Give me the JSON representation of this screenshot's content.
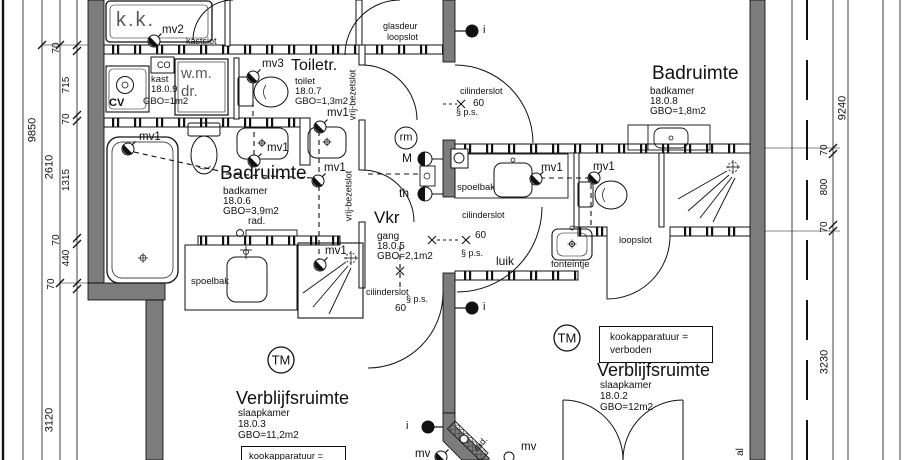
{
  "plan": {
    "rooms": {
      "kk": {
        "title": "k.k."
      },
      "kast": {
        "name": "kast",
        "number": "18.0.9",
        "area": "GBO=1m2",
        "co": "CO",
        "cv": "CV",
        "wm": "w.m.",
        "dr": "dr."
      },
      "toilet": {
        "title": "Toiletr.",
        "type": "toilet",
        "number": "18.0.7",
        "area": "GBO=1,3m2"
      },
      "bad6": {
        "title": "Badruimte",
        "type": "badkamer",
        "number": "18.0.6",
        "area": "GBO=3,9m2"
      },
      "bad8": {
        "title": "Badruimte",
        "type": "badkamer",
        "number": "18.0.8",
        "area": "GBO=1,8m2"
      },
      "vkr": {
        "title": "Vkr",
        "type": "gang",
        "number": "18.0.5",
        "area": "GBO=2,1m2"
      },
      "slaap3": {
        "title": "Verblijfsruimte",
        "type": "slaapkamer",
        "number": "18.0.3",
        "area": "GBO=11,2m2"
      },
      "slaap2": {
        "title": "Verblijfsruimte",
        "type": "slaapkamer",
        "number": "18.0.2",
        "area": "GBO=12m2"
      }
    },
    "locks": {
      "kastslot": "kastslot",
      "loopslot": "loopslot",
      "glasdeur": "glasdeur",
      "vrij_bezetslot": "vrij-bezetslot",
      "cilinderslot": "cilinderslot",
      "door_width": "60",
      "ps": "§ p.s."
    },
    "fixtures": {
      "spoelbak": "spoelbak",
      "fonteintje": "fonteintje",
      "rad": "rad.",
      "luik": "luik"
    },
    "vent": {
      "mv": "mv",
      "mv1": "mv1",
      "mv2": "mv2",
      "mv3": "mv3"
    },
    "symbols": {
      "m": "M",
      "th": "th",
      "rm": "rm",
      "tm": "TM",
      "i": "i",
      "al": "al"
    },
    "warning": {
      "line1": "kookapparatuur =",
      "line2": "verboden"
    },
    "dims": {
      "left": {
        "total": "9850",
        "spans": [
          "2610",
          "3120"
        ],
        "chain": [
          "70",
          "715",
          "70",
          "1315",
          "70",
          "440",
          "70"
        ]
      },
      "right": {
        "total": "9240",
        "spans": [
          "3230"
        ],
        "chain": [
          "70",
          "800",
          "70"
        ]
      }
    },
    "colors": {
      "wall_gray": "#7c7c7c",
      "line": "#111111"
    }
  }
}
